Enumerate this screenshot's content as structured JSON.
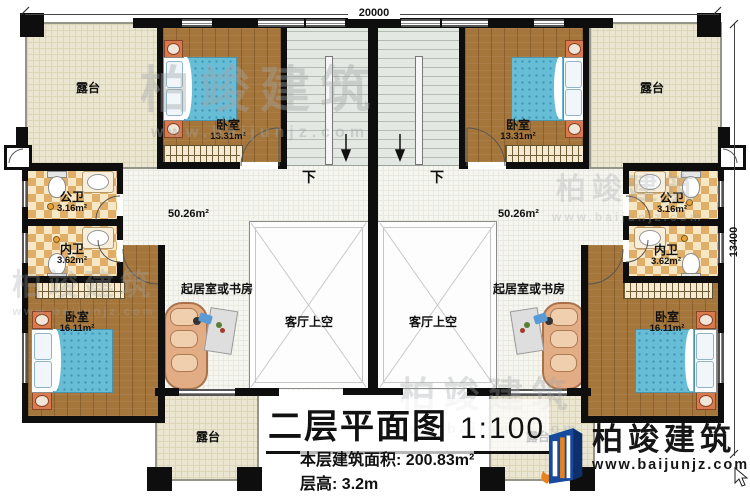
{
  "dimensions": {
    "top": "20000",
    "right": "13400"
  },
  "watermark": {
    "brand": "柏竣建筑",
    "site": "www.baijunjz.com"
  },
  "logo": {
    "brand": "柏竣建筑",
    "site": "www.baijunjz.com"
  },
  "stairs": {
    "down_left": "下",
    "down_right": "下"
  },
  "halls": {
    "left_area": "50.26m²",
    "right_area": "50.26m²"
  },
  "rooms": {
    "terrace_tl": {
      "name": "露台"
    },
    "terrace_tr": {
      "name": "露台"
    },
    "terrace_bl": {
      "name": "露台"
    },
    "terrace_br": {
      "name": "露台"
    },
    "bedroom_tl": {
      "name": "卧室",
      "area": "13.31m²"
    },
    "bedroom_tr": {
      "name": "卧室",
      "area": "13.31m²"
    },
    "bedroom_bl": {
      "name": "卧室",
      "area": "16.11m²"
    },
    "bedroom_br": {
      "name": "卧室",
      "area": "16.11m²"
    },
    "public_bath_l": {
      "name": "公卫",
      "area": "3.16m²"
    },
    "public_bath_r": {
      "name": "公卫",
      "area": "3.16m²"
    },
    "inner_bath_l": {
      "name": "内卫",
      "area": "3.62m²"
    },
    "inner_bath_r": {
      "name": "内卫",
      "area": "3.62m²"
    },
    "study_l": {
      "name": "起居室或书房"
    },
    "study_r": {
      "name": "起居室或书房"
    },
    "void_l": {
      "name": "客厅上空"
    },
    "void_r": {
      "name": "客厅上空"
    }
  },
  "title_block": {
    "title": "二层平面图",
    "scale": "1:100",
    "area_label": "本层建筑面积:",
    "area_value": "200.83m²",
    "height_label": "层高:",
    "height_value": "3.2m"
  }
}
